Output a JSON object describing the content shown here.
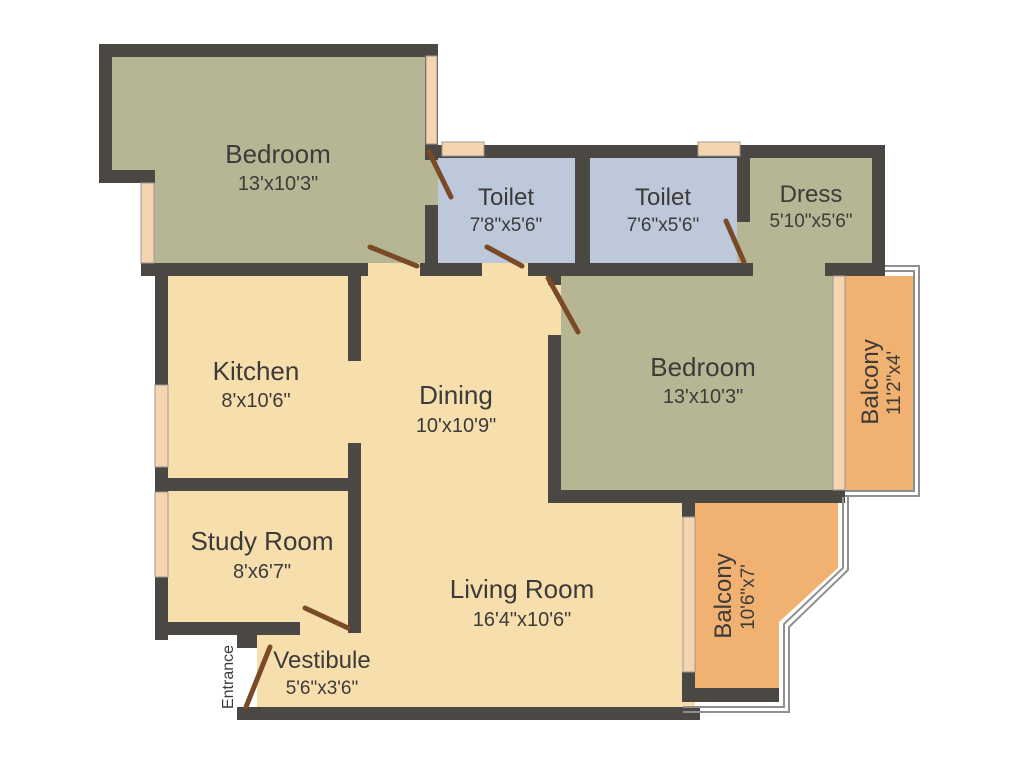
{
  "title": "Apartment Floor Plan",
  "rooms": {
    "bedroom1": {
      "name": "Bedroom",
      "dims": "13'x10'3\""
    },
    "toilet1": {
      "name": "Toilet",
      "dims": "7'8\"x5'6\""
    },
    "toilet2": {
      "name": "Toilet",
      "dims": "7'6\"x5'6\""
    },
    "dress": {
      "name": "Dress",
      "dims": "5'10\"x5'6\""
    },
    "bedroom2": {
      "name": "Bedroom",
      "dims": "13'x10'3\""
    },
    "balcony1": {
      "name": "Balcony",
      "dims": "11'2\"x4'"
    },
    "kitchen": {
      "name": "Kitchen",
      "dims": "8'x10'6\""
    },
    "dining": {
      "name": "Dining",
      "dims": "10'x10'9\""
    },
    "study": {
      "name": "Study Room",
      "dims": "8'x6'7\""
    },
    "living": {
      "name": "Living Room",
      "dims": "16'4\"x10'6\""
    },
    "balcony2": {
      "name": "Balcony",
      "dims": "10'6\"x7'"
    },
    "vestibule": {
      "name": "Vestibule",
      "dims": "5'6\"x3'6\""
    }
  },
  "labels": {
    "entrance": "Entrance"
  },
  "colors": {
    "wall": "#4b4742",
    "floor_cream": "#f7dfad",
    "floor_olive": "#b6b694",
    "floor_blue": "#bdc8da",
    "floor_orange": "#f1b170",
    "window": "#f7d4b0",
    "door": "#7a4a28",
    "railing": "#8f8f8f",
    "text": "#3c3b39",
    "background": "#ffffff"
  }
}
